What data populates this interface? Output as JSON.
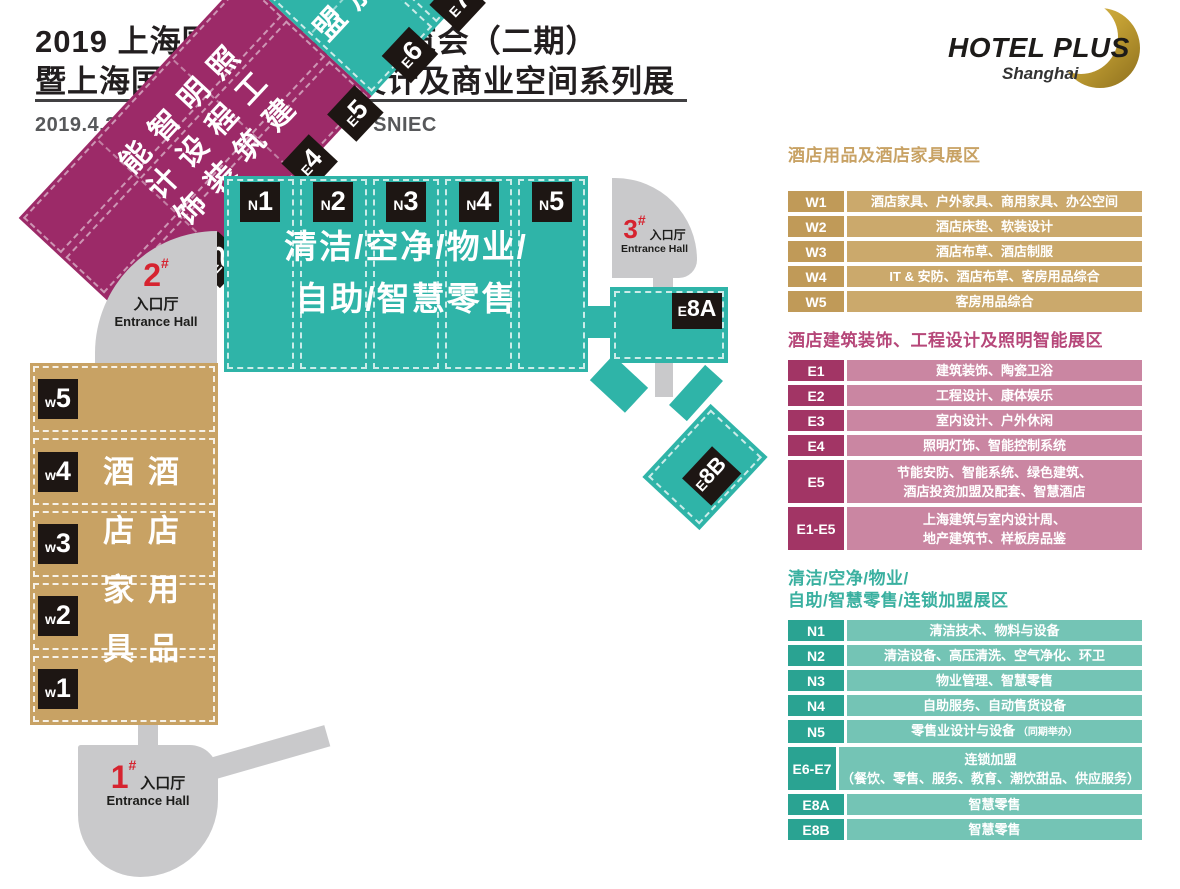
{
  "header": {
    "title_line1": "2019 上海国际酒店用品博览会（二期）",
    "title_line2": "暨上海国际酒店工程、设计及商业空间系列展",
    "date_venue": "2019.4.26-4.28  上海新国际博览中心  SNIEC",
    "logo": {
      "name": "HOTEL PLUS",
      "sub": "Shanghai"
    }
  },
  "palette": {
    "teal": "#2fb4a8",
    "tan": "#c8a264",
    "magenta": "#9c2a68",
    "gray": "#c9c9cb",
    "black_box": "#1d1613",
    "entrance_red": "#d6232f",
    "gold": "#c3a034"
  },
  "map": {
    "n_hall": {
      "sections": [
        "N1",
        "N2",
        "N3",
        "N4",
        "N5"
      ],
      "text_line1": "清洁/空净/物业/",
      "text_line2": "自助/智慧零售"
    },
    "w_hall": {
      "sections": [
        "W5",
        "W4",
        "W3",
        "W2",
        "W1"
      ],
      "col_right": "酒店用品",
      "col_left": "酒店家具"
    },
    "e8a": {
      "label": "E8A"
    },
    "e8b": {
      "label": "E8B"
    },
    "band": {
      "magenta_labels": [
        "E1",
        "E2",
        "E3",
        "E4",
        "E5"
      ],
      "teal_labels": [
        "E6",
        "E7"
      ],
      "magenta_columns": [
        "建筑装饰",
        "工程设计",
        "照明智能"
      ],
      "teal_text": "连锁加盟"
    },
    "entrances": {
      "e1": {
        "num": "1",
        "hash": "#",
        "cn": "入口厅",
        "en": "Entrance Hall"
      },
      "e2": {
        "num": "2",
        "hash": "#",
        "cn": "入口厅",
        "en": "Entrance Hall"
      },
      "e3": {
        "num": "3",
        "hash": "#",
        "cn": "入口厅",
        "en": "Entrance Hall"
      }
    }
  },
  "legend": {
    "sections": [
      {
        "theme": "tan",
        "title_lines": [
          "酒店用品及酒店家具展区"
        ],
        "rows": [
          {
            "label": "W1",
            "lines": [
              "酒店家具、户外家具、商用家具、办公空间"
            ]
          },
          {
            "label": "W2",
            "lines": [
              "酒店床垫、软装设计"
            ]
          },
          {
            "label": "W3",
            "lines": [
              "酒店布草、酒店制服"
            ]
          },
          {
            "label": "W4",
            "lines": [
              "IT & 安防、酒店布草、客房用品综合"
            ]
          },
          {
            "label": "W5",
            "lines": [
              "客房用品综合"
            ]
          }
        ]
      },
      {
        "theme": "magenta",
        "title_lines": [
          "酒店建筑装饰、工程设计及照明智能展区"
        ],
        "rows": [
          {
            "label": "E1",
            "lines": [
              "建筑装饰、陶瓷卫浴"
            ]
          },
          {
            "label": "E2",
            "lines": [
              "工程设计、康体娱乐"
            ]
          },
          {
            "label": "E3",
            "lines": [
              "室内设计、户外休闲"
            ]
          },
          {
            "label": "E4",
            "lines": [
              "照明灯饰、智能控制系统"
            ]
          },
          {
            "label": "E5",
            "lines": [
              "节能安防、智能系统、绿色建筑、",
              "酒店投资加盟及配套、智慧酒店"
            ]
          },
          {
            "label": "E1-E5",
            "lines": [
              "上海建筑与室内设计周、",
              "地产建筑节、样板房品鉴"
            ]
          }
        ]
      },
      {
        "theme": "teal",
        "title_lines": [
          "清洁/空净/物业/",
          "自助/智慧零售/连锁加盟展区"
        ],
        "rows": [
          {
            "label": "N1",
            "lines": [
              "清洁技术、物料与设备"
            ]
          },
          {
            "label": "N2",
            "lines": [
              "清洁设备、高压清洗、空气净化、环卫"
            ]
          },
          {
            "label": "N3",
            "lines": [
              "物业管理、智慧零售"
            ]
          },
          {
            "label": "N4",
            "lines": [
              "自助服务、自动售货设备"
            ]
          },
          {
            "label": "N5",
            "lines": [
              "零售业设计与设备"
            ],
            "note": "（同期举办）"
          },
          {
            "label": "E6-E7",
            "lines": [
              "连锁加盟",
              "（餐饮、零售、服务、教育、潮饮甜品、供应服务）"
            ]
          },
          {
            "label": "E8A",
            "lines": [
              "智慧零售"
            ]
          },
          {
            "label": "E8B",
            "lines": [
              "智慧零售"
            ]
          }
        ]
      }
    ]
  }
}
